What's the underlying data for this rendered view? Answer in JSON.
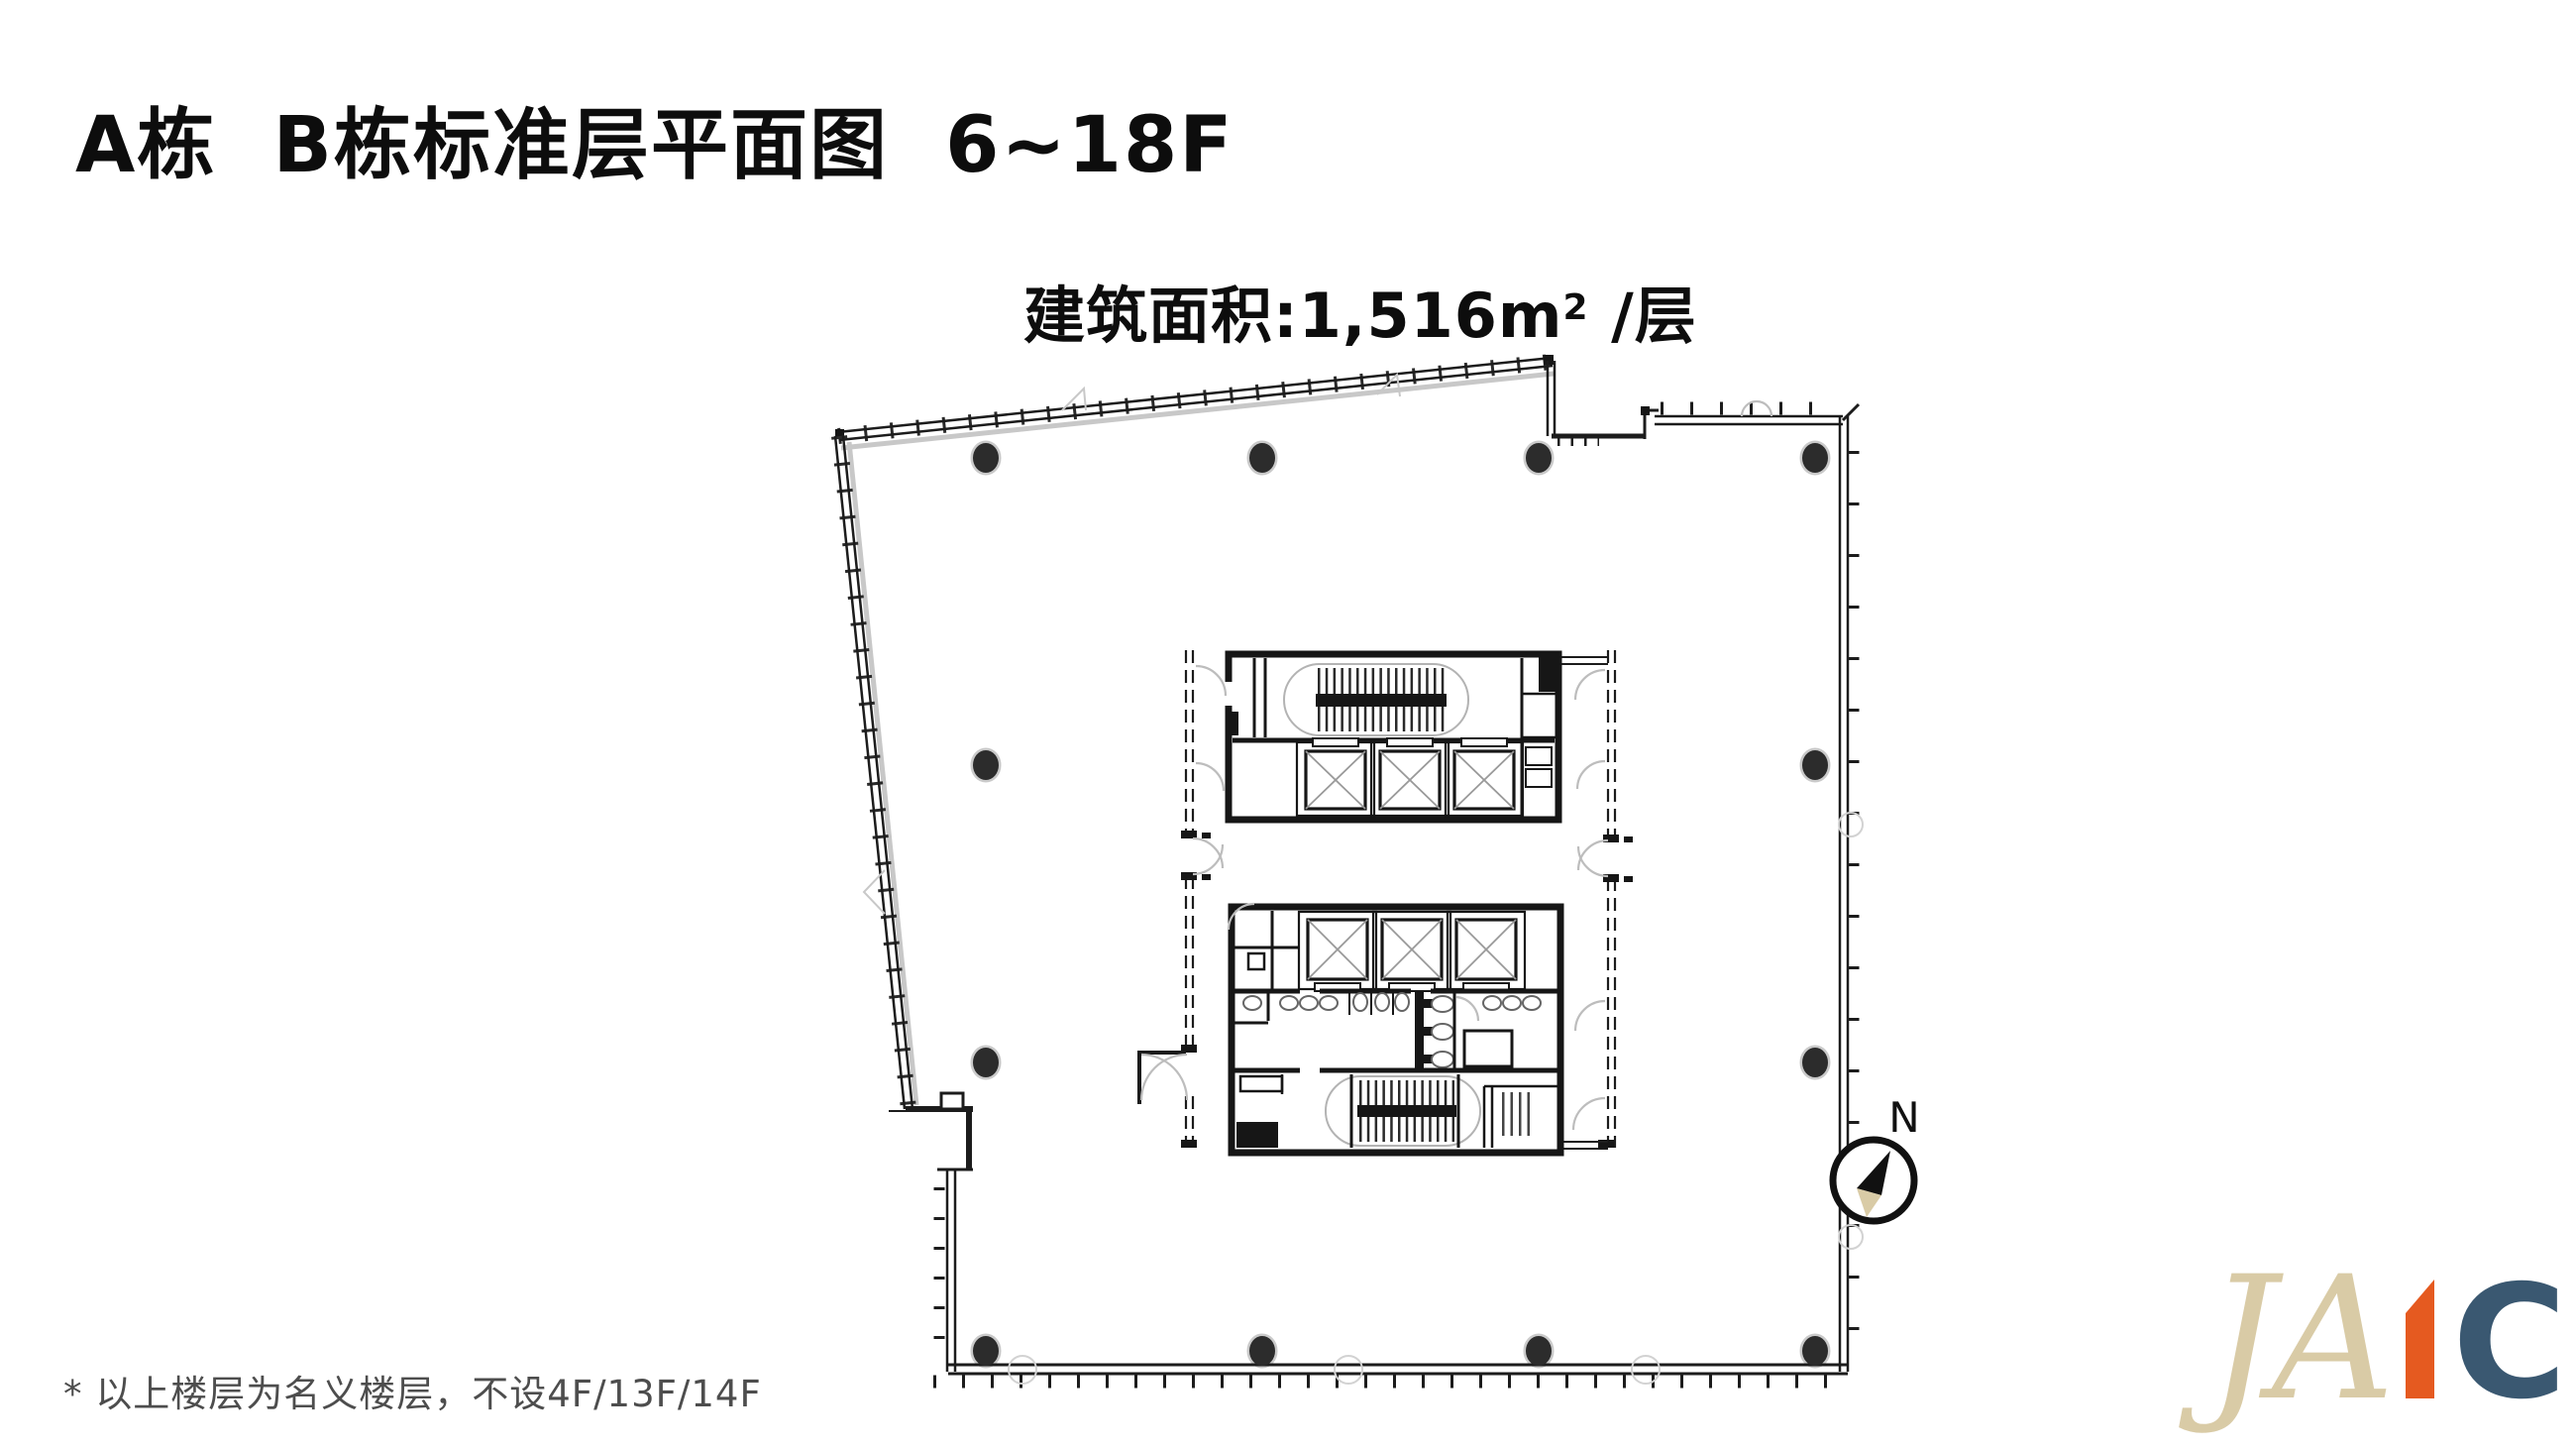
{
  "page": {
    "background_color": "#ffffff"
  },
  "header": {
    "title": "A栋 B栋标准层平面图 6~18F"
  },
  "plan": {
    "area_label": {
      "prefix": "建筑面积:1,516m",
      "superscript": "2",
      "suffix": " /层"
    },
    "compass": {
      "label": "N"
    },
    "colors": {
      "line": "#1c1c1c",
      "column": "#2c2c2c",
      "curtain_hatch": "#c8c8c8",
      "stair_outline": "#b3b3b3",
      "door_arc": "#bdbdbd"
    }
  },
  "footnote": {
    "text": "* 以上楼层为名义楼层，不设4F/13F/14F",
    "color": "#4d4d4d"
  },
  "logo": {
    "part1": "JA",
    "part1_color": "#d9cba6",
    "accent_color": "#e55a20",
    "part2": "C",
    "part2_color": "#3a5871"
  }
}
